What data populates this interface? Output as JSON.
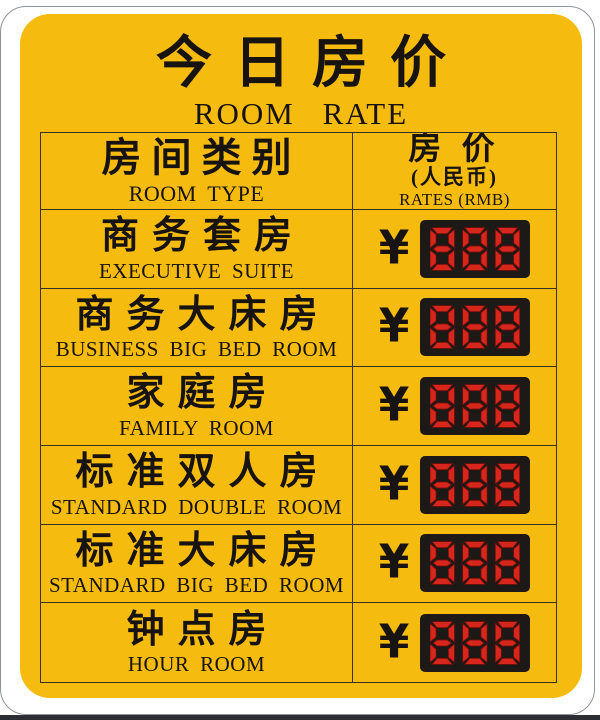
{
  "sign": {
    "title_zh": "今日房价",
    "title_en": "ROOM RATE",
    "currency_symbol": "¥",
    "colors": {
      "sign_background": "#F6BB0F",
      "text": "#171310",
      "led_background": "#1C1916",
      "led_segment_red": "#D7271C",
      "table_border": "#343128"
    },
    "table": {
      "header": {
        "room_type_zh": "房间类别",
        "room_type_en": "ROOM TYPE",
        "rate_zh": "房 价",
        "rate_note_zh": "(人民币)",
        "rate_en": "RATES (RMB)"
      },
      "rows": [
        {
          "name_zh": "商务套房",
          "name_en": "EXECUTIVE SUITE",
          "price_display": "888"
        },
        {
          "name_zh": "商务大床房",
          "name_en": "BUSINESS BIG BED ROOM",
          "price_display": "888"
        },
        {
          "name_zh": "家庭房",
          "name_en": "FAMILY ROOM",
          "price_display": "888"
        },
        {
          "name_zh": "标准双人房",
          "name_en": "STANDARD DOUBLE ROOM",
          "price_display": "888"
        },
        {
          "name_zh": "标准大床房",
          "name_en": "STANDARD BIG BED ROOM",
          "price_display": "888"
        },
        {
          "name_zh": "钟点房",
          "name_en": "HOUR ROOM",
          "price_display": "888"
        }
      ]
    }
  }
}
